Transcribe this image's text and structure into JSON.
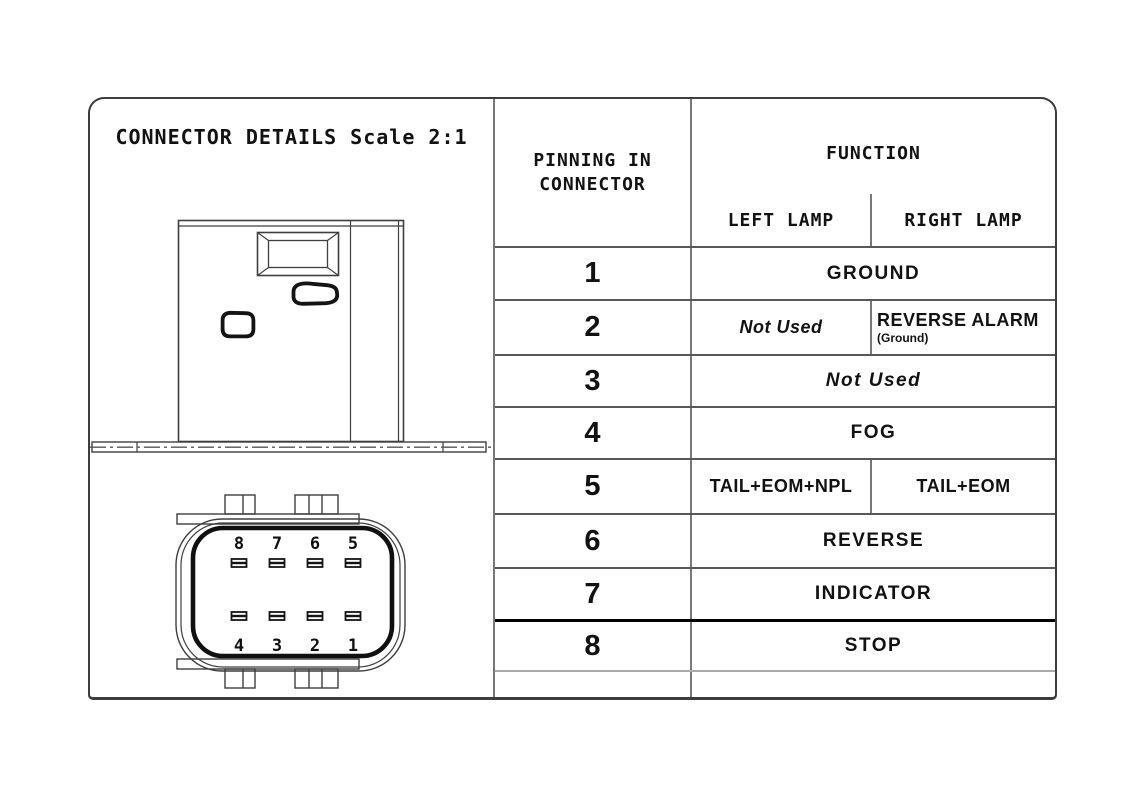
{
  "title": "CONNECTOR DETAILS Scale 2:1",
  "table": {
    "header": {
      "pinning_line1": "PINNING IN",
      "pinning_line2": "CONNECTOR",
      "function": "FUNCTION",
      "left_lamp": "LEFT LAMP",
      "right_lamp": "RIGHT LAMP"
    },
    "rows": [
      {
        "pin": "1",
        "function": "GROUND"
      },
      {
        "pin": "2",
        "left": "Not Used",
        "right": "REVERSE ALARM",
        "right_note": "(Ground)"
      },
      {
        "pin": "3",
        "function": "Not Used"
      },
      {
        "pin": "4",
        "function": "FOG"
      },
      {
        "pin": "5",
        "left": "TAIL+EOM+NPL",
        "right": "TAIL+EOM"
      },
      {
        "pin": "6",
        "function": "REVERSE"
      },
      {
        "pin": "7",
        "function": "INDICATOR"
      },
      {
        "pin": "8",
        "function": "STOP"
      }
    ]
  },
  "connector_front_view": {
    "pins_top": [
      "8",
      "7",
      "6",
      "5"
    ],
    "pins_bottom": [
      "4",
      "3",
      "2",
      "1"
    ]
  },
  "colors": {
    "background": "#ffffff",
    "text": "#121212",
    "line": "#3f3f3f",
    "line_light": "#aaaaaa",
    "line_heavy": "#0d0d0d"
  }
}
